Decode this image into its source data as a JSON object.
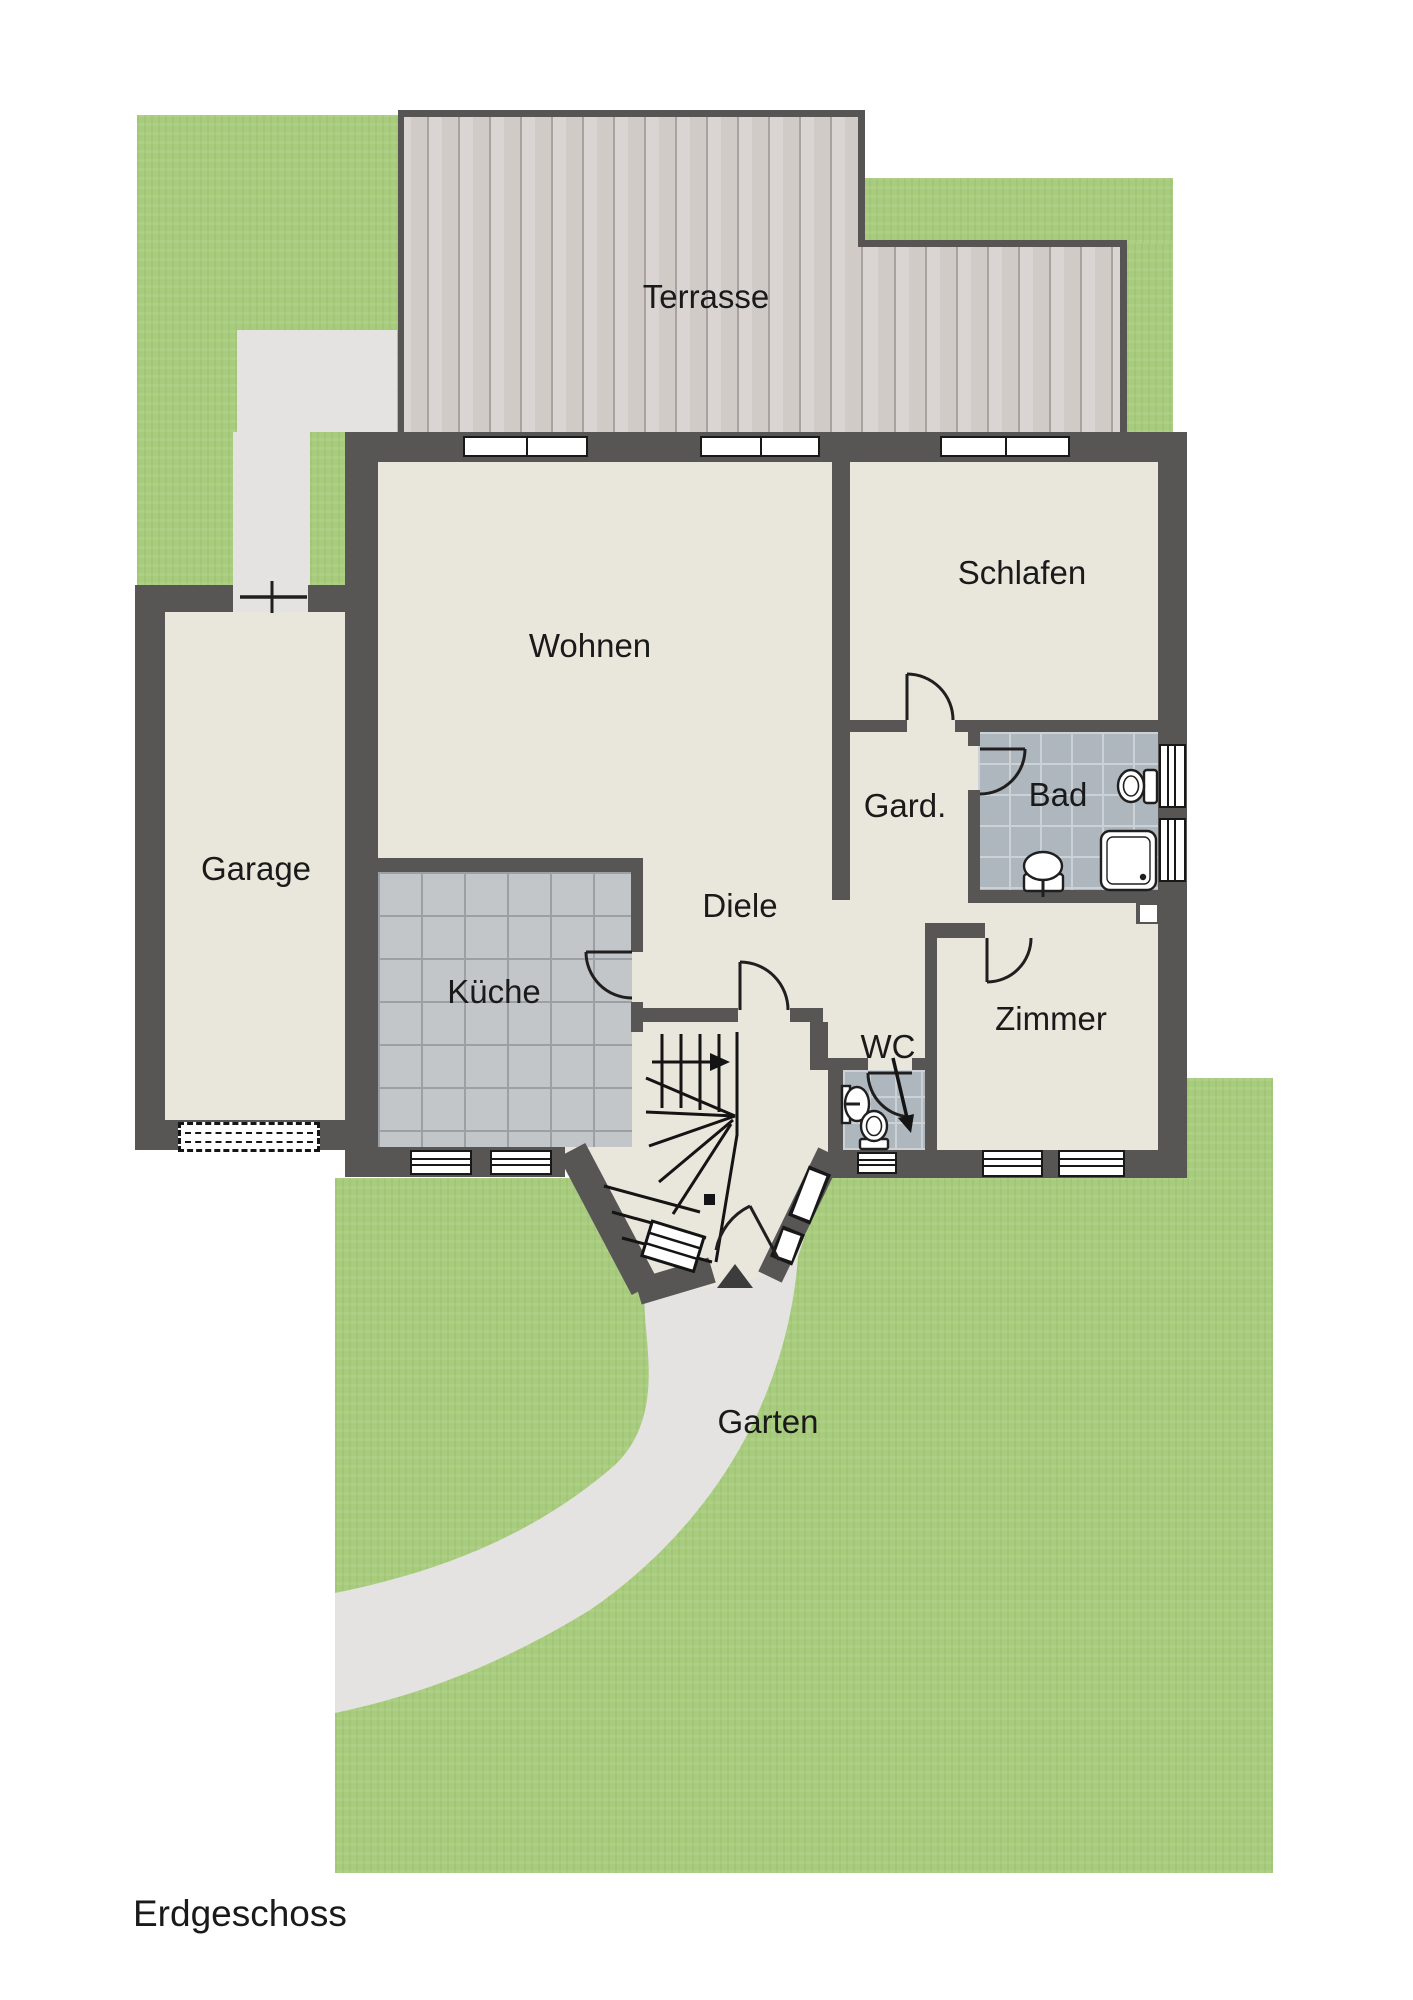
{
  "title": "Erdgeschoss",
  "rooms": {
    "terrasse": {
      "label": "Terrasse"
    },
    "wohnen": {
      "label": "Wohnen"
    },
    "schlafen": {
      "label": "Schlafen"
    },
    "garage": {
      "label": "Garage"
    },
    "kueche": {
      "label": "Küche"
    },
    "diele": {
      "label": "Diele"
    },
    "garderobe": {
      "label": "Gard."
    },
    "bad": {
      "label": "Bad"
    },
    "wc": {
      "label": "WC"
    },
    "zimmer": {
      "label": "Zimmer"
    },
    "garten": {
      "label": "Garten"
    }
  },
  "colors": {
    "grass": "#a8cc7d",
    "wood": "#d6d1ce",
    "wall": "#575655",
    "floor": "#e9e6db",
    "kitchen_tile": "#c3c6c9",
    "bath_tile": "#aeb6be",
    "path": "#e4e3e1",
    "text": "#1a1a1a"
  }
}
